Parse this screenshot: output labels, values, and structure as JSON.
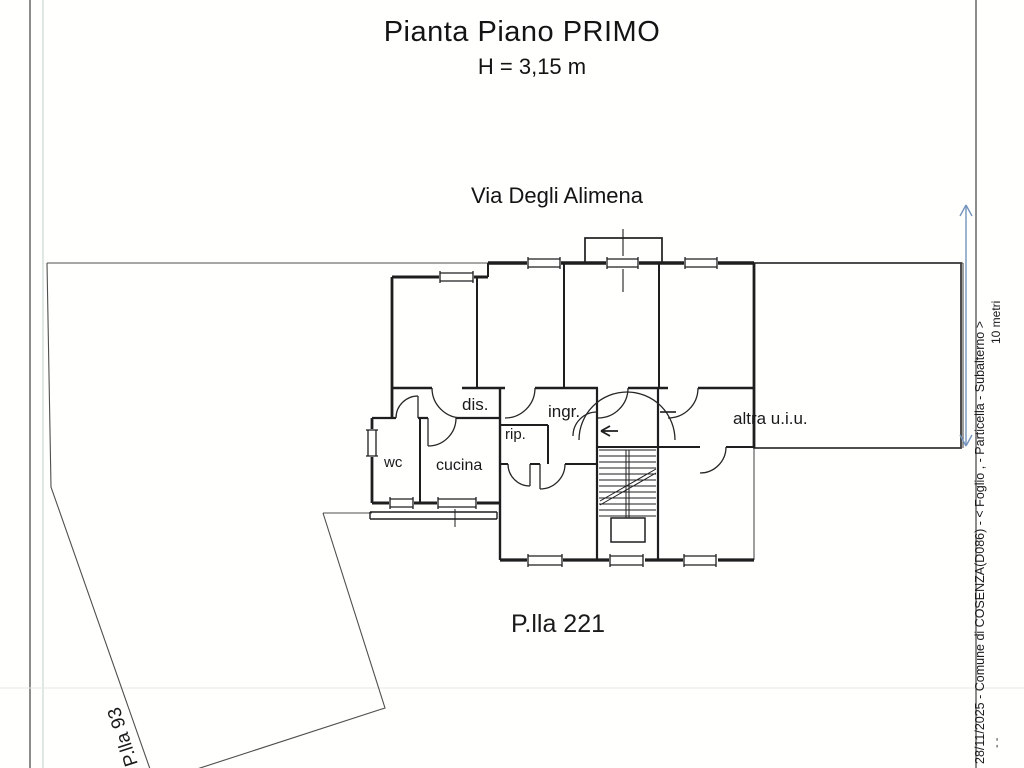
{
  "page": {
    "title": "Pianta Piano PRIMO",
    "subtitle": "H = 3,15 m",
    "street": "Via Degli Alimena"
  },
  "plan": {
    "rooms": {
      "dis": "dis.",
      "ingr": "ingr.",
      "rip": "rip.",
      "wc": "wc",
      "cucina": "cucina",
      "altra_uiu": "altra u.i.u."
    },
    "parcels": {
      "subject": "P.lla 221",
      "neighbor": "P.lla 93"
    }
  },
  "scale_bar": {
    "label": "10 metri"
  },
  "side_caption": {
    "text": "28/11/2025 - Comune di COSENZA(D086) - <  Foglio ,   - Particella    - Subalterno    >",
    "scan_mark": "- -"
  },
  "colors": {
    "ink": "#1e1e1e",
    "parcel_line": "#4f4f4f",
    "scale_blue": "#7394bd",
    "paper": "#ffffff"
  }
}
